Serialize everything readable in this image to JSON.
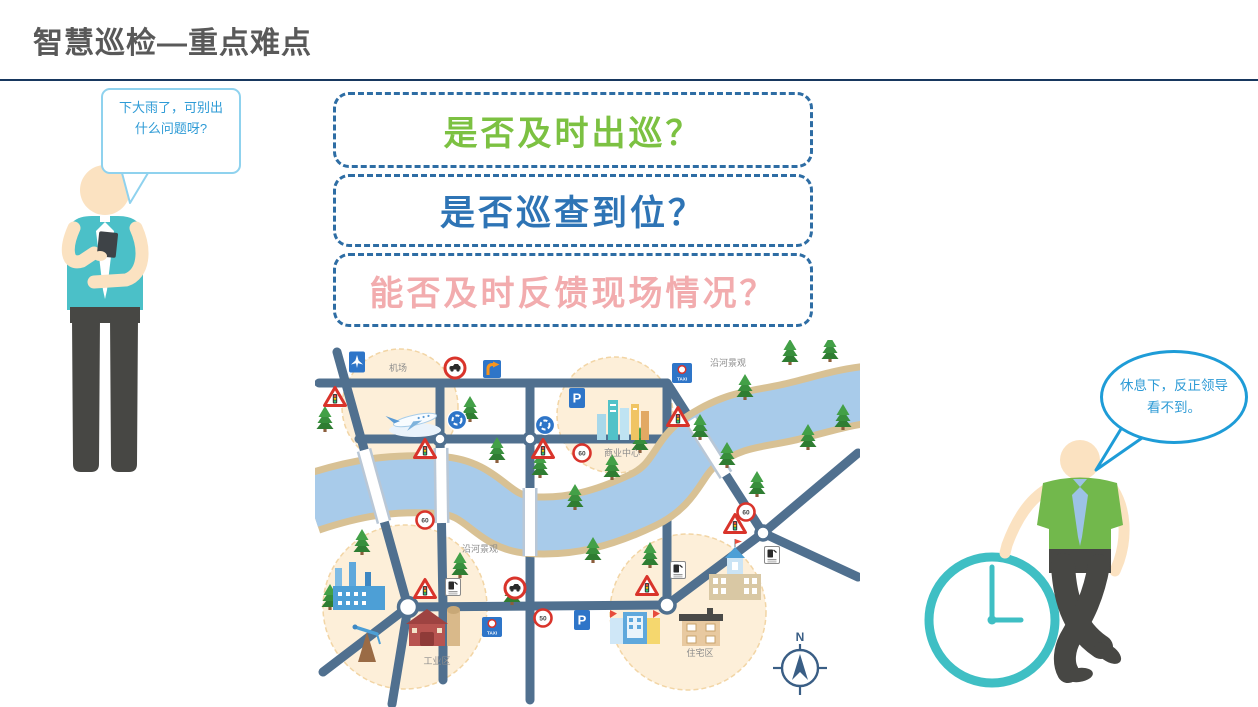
{
  "slide": {
    "title": "智慧巡检—重点难点"
  },
  "left_worker": {
    "bubble_text": "下大雨了，可别出什么问题呀?"
  },
  "right_worker": {
    "bubble_text": "休息下，反正领导看不到。"
  },
  "questions": [
    {
      "label": "是否及时出巡？",
      "color": "#7CC142"
    },
    {
      "label": "是否巡查到位？",
      "color": "#2E74B5"
    },
    {
      "label": "能否及时反馈现场情况？",
      "color": "#F2ACAE"
    }
  ],
  "map": {
    "labels": {
      "airport": "机场",
      "commercial": "商业中心",
      "riverside": "沿河景观",
      "industrial": "工业区",
      "residential": "住宅区"
    },
    "signs": {
      "parking": "P",
      "taxi": "TAXI",
      "speed60": "60",
      "speed50": "50"
    },
    "compass": {
      "north": "N"
    },
    "icons": [
      "airport-sign",
      "no-cars-sign",
      "right-turn-sign",
      "roundabout-sign",
      "traffic-light-warning-sign",
      "gas-station-sign",
      "parking-sign",
      "taxi-stand-sign",
      "speed-limit-sign",
      "pine-tree",
      "airplane",
      "compass-rose"
    ],
    "colors": {
      "road": "#50708F",
      "river": "#A8CBEA",
      "river_bank": "#D8C194",
      "zone_fill": "#FDEFD9",
      "sign_blue": "#2E75C8",
      "sign_red": "#D9342B"
    }
  },
  "theme": {
    "title_color": "#595959",
    "divider_color": "#17375E",
    "dashed_box_border": "#2E6DA4",
    "bubble_border_left": "#8FD2EE",
    "bubble_border_right": "#1E9CD7",
    "bubble_text_color": "#2E9BD6",
    "clock_color": "#3FBFC4",
    "left_shirt": "#4BC0C8",
    "right_shirt": "#72B84C",
    "pants": "#474744",
    "skin": "#FBE2C1"
  }
}
